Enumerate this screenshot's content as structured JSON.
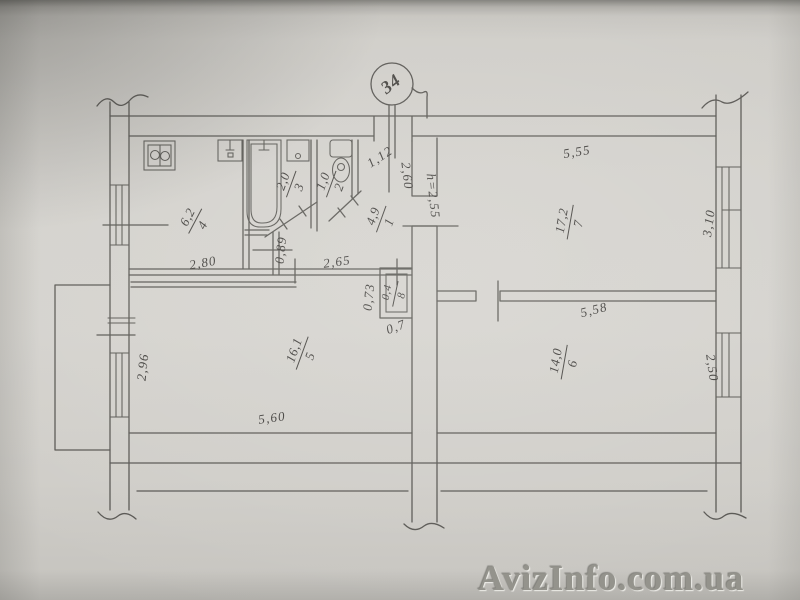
{
  "title": "Apartment floor plan photo",
  "callout": {
    "apartment_number": "34"
  },
  "watermark": "AvizInfo.com.ua",
  "colors": {
    "ink": "#4e4c48",
    "paper": "#d3d1cc"
  },
  "rooms": [
    {
      "number": "1",
      "area": "4,9"
    },
    {
      "number": "2",
      "area": "1,0"
    },
    {
      "number": "3",
      "area": "2,0"
    },
    {
      "number": "4",
      "area": "6,2"
    },
    {
      "number": "5",
      "area": "16,1"
    },
    {
      "number": "6",
      "area": "14,0"
    },
    {
      "number": "7",
      "area": "17,2"
    },
    {
      "number": "8",
      "area": "0,4"
    }
  ],
  "dims": {
    "room7_top": "5,55",
    "room7_right": "3,10",
    "room7_bottom": "5,58",
    "room6_right": "2,50",
    "room5_bottom": "5,60",
    "room5_left": "2,96",
    "kitchen_bottom": "2,80",
    "hall_bottom": "2,65",
    "door_width": "0,89",
    "closet_side": "0,73",
    "closet_bottom": "0,7",
    "hall_right": "2,60",
    "entry_width": "1,12",
    "ceiling_height": "h=2,55"
  }
}
